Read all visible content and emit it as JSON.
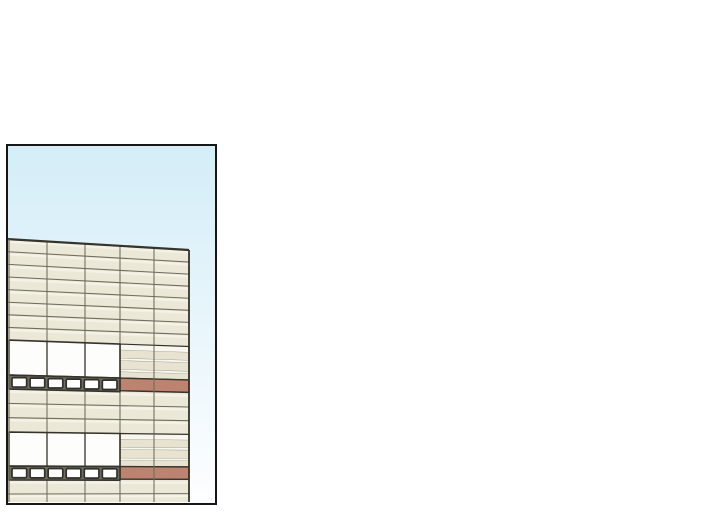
{
  "page": {
    "background": "#ffffff"
  },
  "panel": {
    "left": 6,
    "top": 144,
    "width": 211,
    "height": 361,
    "border_color": "#161616",
    "border_width": 2.5,
    "sky": {
      "top_color": "#d4edf8",
      "bottom_color": "#fdfeff"
    },
    "building": {
      "x_left": -2,
      "x_right": 181,
      "top_y_left": 93,
      "top_drop": 11,
      "vanish_y": 340,
      "columns": [
        39,
        77,
        112,
        146
      ],
      "palette": {
        "facade": "#ebe8d7",
        "facade_light": "#f4f2e6",
        "line": "#6f6c5d",
        "line_dark": "#35332a",
        "window": "#fdfdfb",
        "stripe_red": "#bd8371",
        "stripe_beige": "#e7e3d0",
        "stripe_white": "#f7f6ef",
        "squares_bg": "#6f6c62",
        "square_fill": "#ffffff",
        "square_border": "#312f29"
      },
      "sections": [
        {
          "kind": "rows",
          "y0": 93,
          "y1": 194,
          "count": 8
        },
        {
          "kind": "feature",
          "win_y0": 194,
          "win_y1": 229,
          "band_y1": 243
        },
        {
          "kind": "rows",
          "y0": 243,
          "y1": 286,
          "count": 3
        },
        {
          "kind": "feature",
          "win_y0": 286,
          "win_y1": 320,
          "band_y1": 334
        },
        {
          "kind": "rows",
          "y0": 334,
          "y1": 362,
          "count": 2
        }
      ],
      "feature_layout": {
        "win_x0": 1,
        "win_x1": 112,
        "win_dividers": [
          39,
          77
        ],
        "stripe_mid_divider": 146,
        "stripe_pattern": [
          [
            "white",
            0.18
          ],
          [
            "beige",
            0.24
          ],
          [
            "white",
            0.07
          ],
          [
            "beige",
            0.26
          ],
          [
            "white",
            0.07
          ],
          [
            "beige",
            0.18
          ]
        ],
        "squares": {
          "count": 6,
          "gap": 3.4,
          "inset": 2.3,
          "pad": 3
        }
      }
    }
  }
}
